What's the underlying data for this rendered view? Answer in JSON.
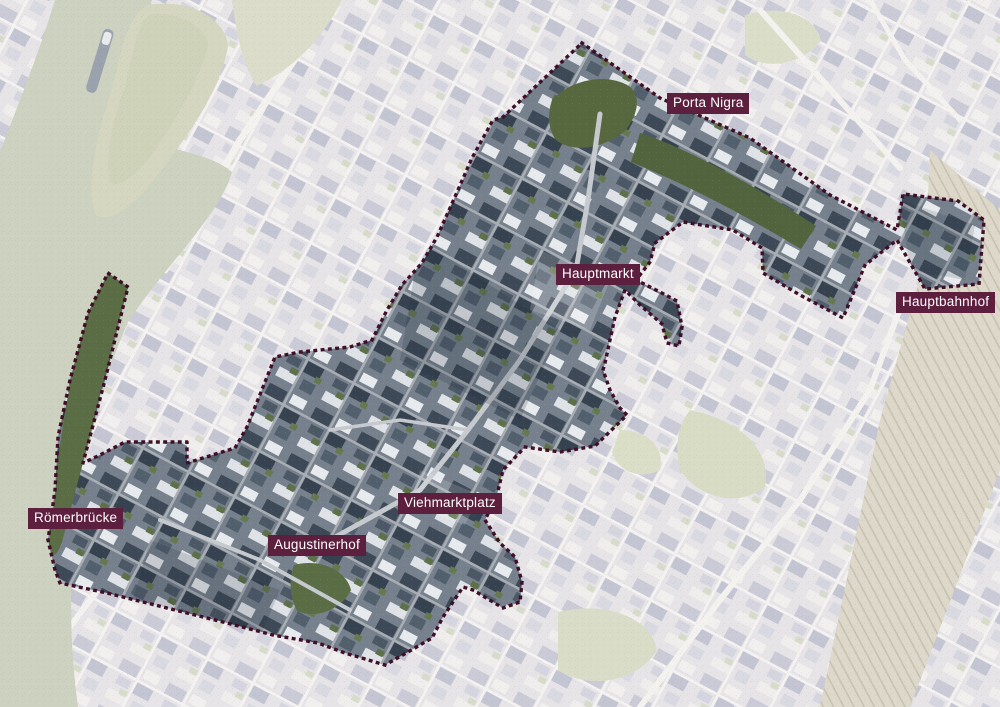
{
  "labels": [
    {
      "text": "Porta Nigra"
    },
    {
      "text": "Hauptmarkt"
    },
    {
      "text": "Hauptbahnhof"
    },
    {
      "text": "Römerbrücke"
    },
    {
      "text": "Augustinerhof"
    },
    {
      "text": "Viehmarktplatz"
    }
  ],
  "colors": {
    "label_background": "#5c1f3e",
    "label_text": "#ffffff",
    "boundary_dots": "#3f0f28",
    "water": "#ccd1c0",
    "faded_map_base": "#e7e4e7",
    "city_buildings_dark": "#3d4957",
    "greenery": "#5a6d45"
  }
}
